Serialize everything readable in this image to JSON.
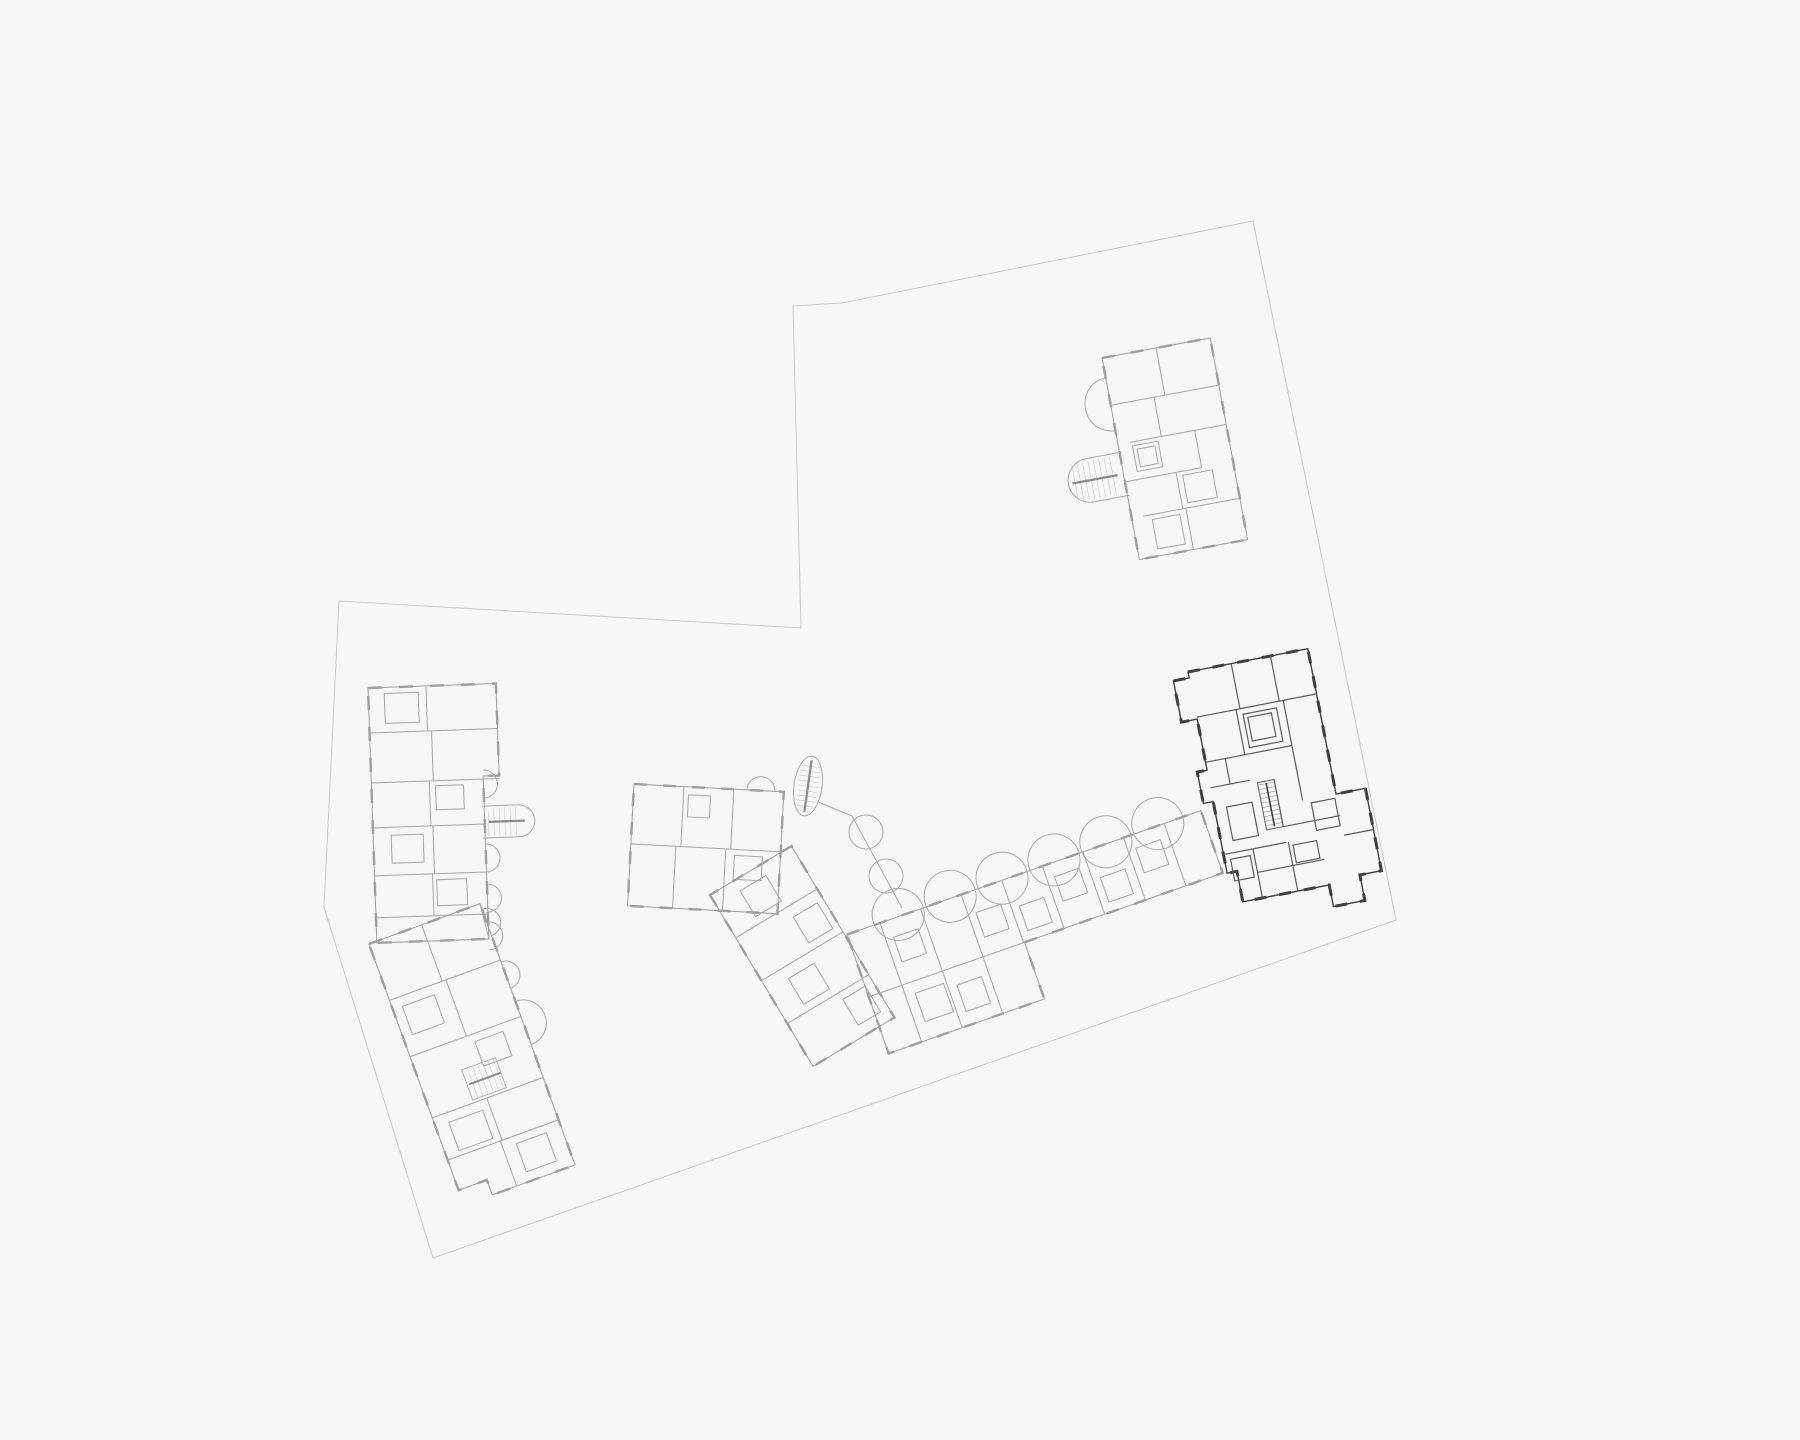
{
  "document": {
    "kind": "architectural-site-floor-plan",
    "visible_text": [],
    "background_color": "#f7f7f6"
  },
  "colors": {
    "background": "#f7f7f6",
    "boundary": "#c9c9c9",
    "wall_light": "#9e9e9e",
    "wall_lighter": "#b3b3b3",
    "wall_mid": "#8a8a8a",
    "wall_dark": "#3f3f3f",
    "wall_dark_inner": "#5c5c5c",
    "hatch_light": "#bdbdbd",
    "hatch_dark": "#6a6a6a"
  },
  "site": {
    "boundary_name": "parcel-boundary",
    "buildings": [
      {
        "id": "building-top-right",
        "style": "light",
        "note": "detached block with stair tower and round balcony"
      },
      {
        "id": "building-left-slab",
        "style": "light",
        "note": "bent slab with semicircular balconies and stair tower"
      },
      {
        "id": "building-central",
        "style": "light",
        "note": "block with diagonal wing and long wing with round balconies"
      },
      {
        "id": "building-dark",
        "style": "dark-highlighted",
        "note": "highlighted floor plan at east side"
      }
    ]
  }
}
